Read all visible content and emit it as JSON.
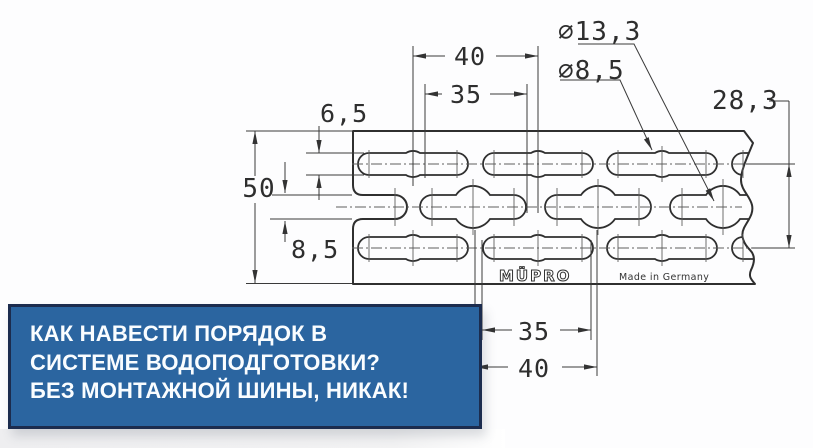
{
  "drawing": {
    "dims": {
      "pitch_top": "40",
      "slot_len_top": "35",
      "edge_offset": "6,5",
      "height": "50",
      "slot_width": "8,5",
      "hole_large": "⌀13,3",
      "hole_small": "⌀8,5",
      "row_spacing": "28,3",
      "slot_len_bottom": "35",
      "pitch_bottom": "40"
    },
    "labels": {
      "brand": "MÜPRO",
      "origin": "Made in Germany"
    },
    "line_color": "#2f2f2f"
  },
  "banner": {
    "line1": "КАК НАВЕСТИ ПОРЯДОК В",
    "line2": "СИСТЕМЕ ВОДОПОДГОТОВКИ?",
    "line3": "БЕЗ МОНТАЖНОЙ ШИНЫ, НИКАК!",
    "bg_color": "#2b65a0",
    "border_color": "#1c2c4e",
    "text_color": "#fafdff"
  }
}
